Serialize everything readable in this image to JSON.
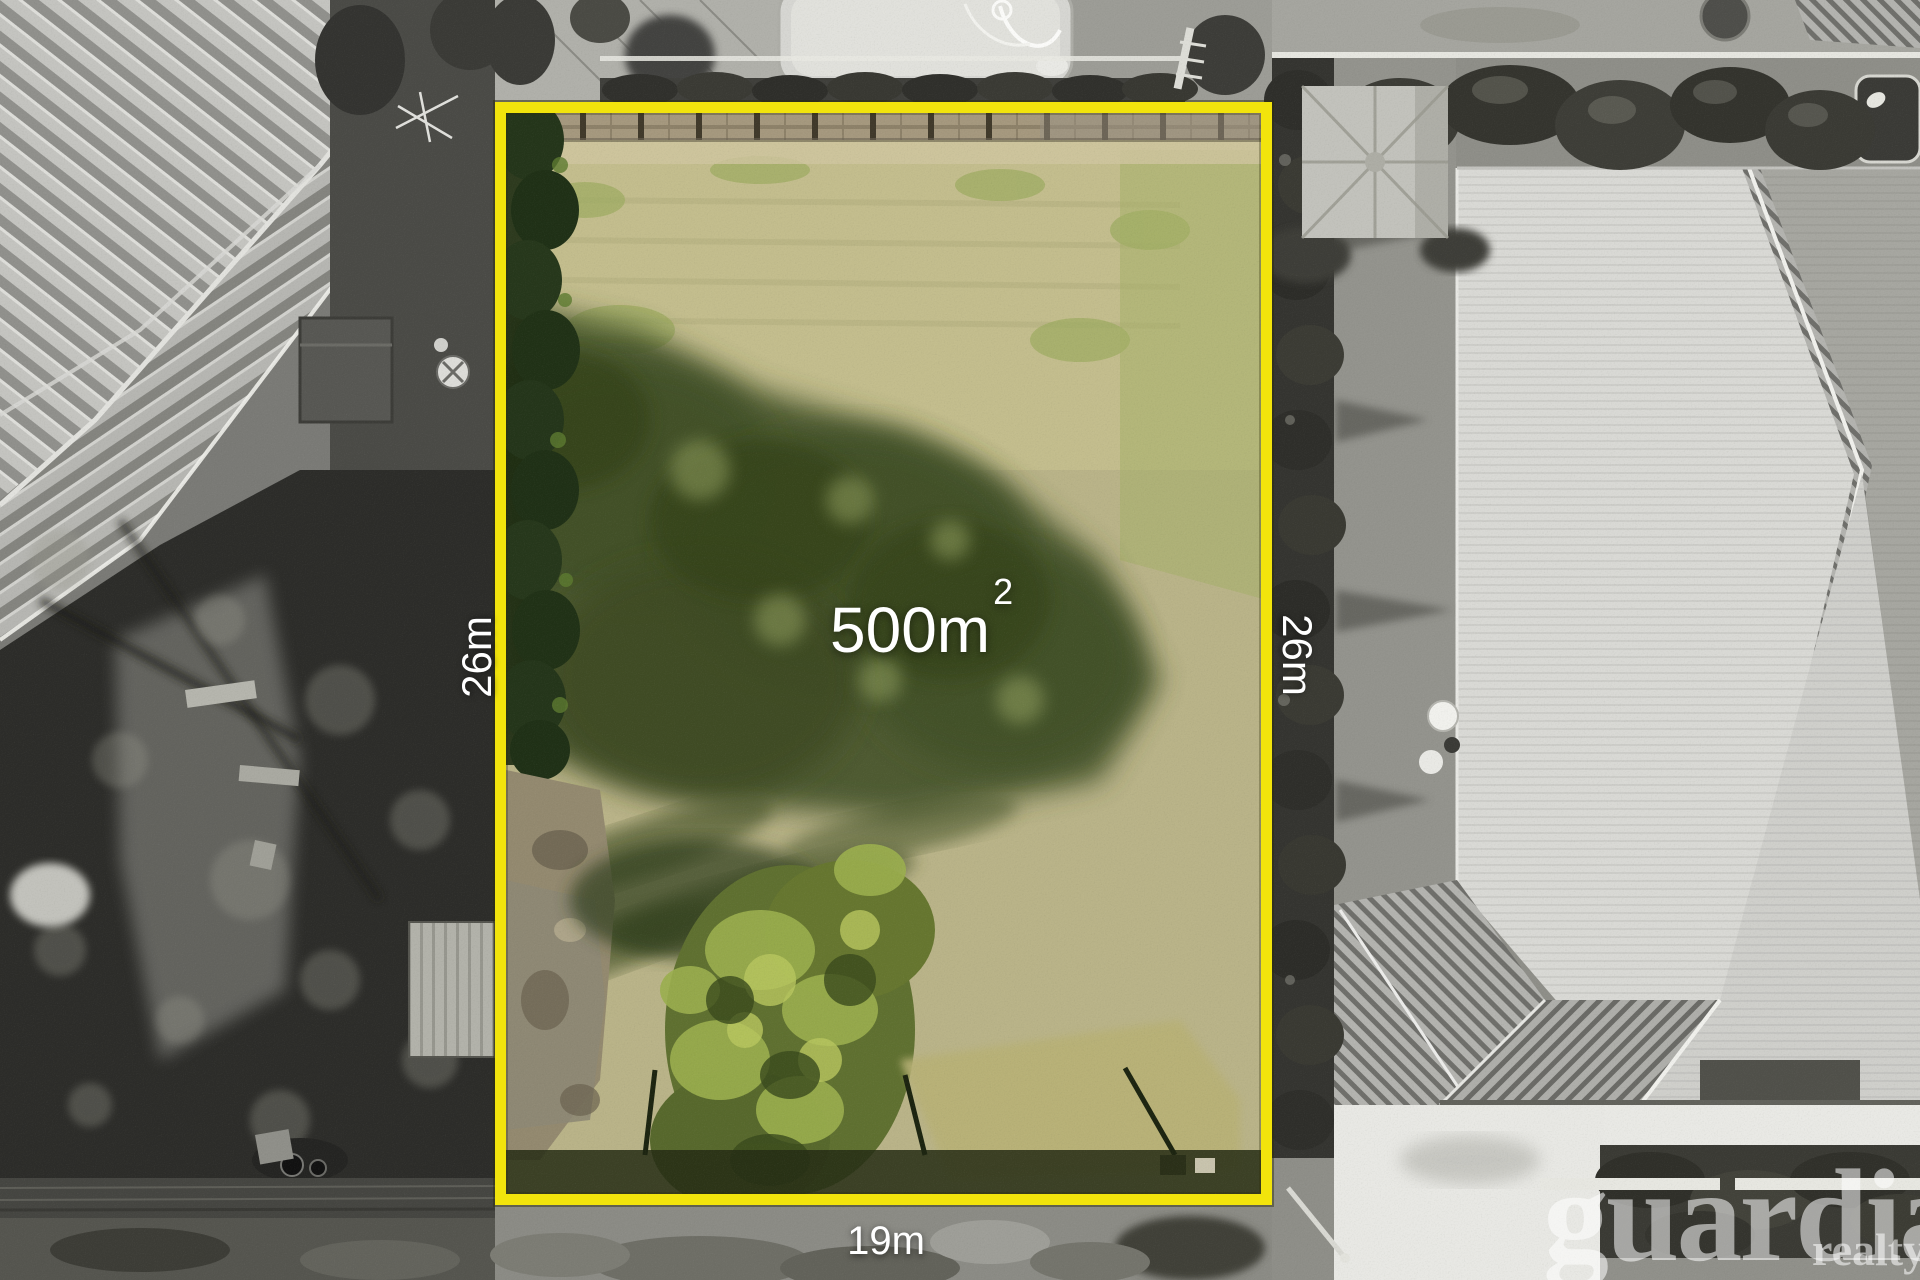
{
  "overlay": {
    "area": {
      "value": "500m",
      "superscript": "2"
    },
    "dimensions": {
      "left_side": "26m",
      "right_side": "26m",
      "frontage": "19m"
    }
  },
  "watermark": {
    "brand": "guardian",
    "subtitle": "realty"
  },
  "colors": {
    "boundary_yellow": "#f2e40c",
    "dimension_text": "#ffffff",
    "watermark_text": "#ffffff"
  }
}
